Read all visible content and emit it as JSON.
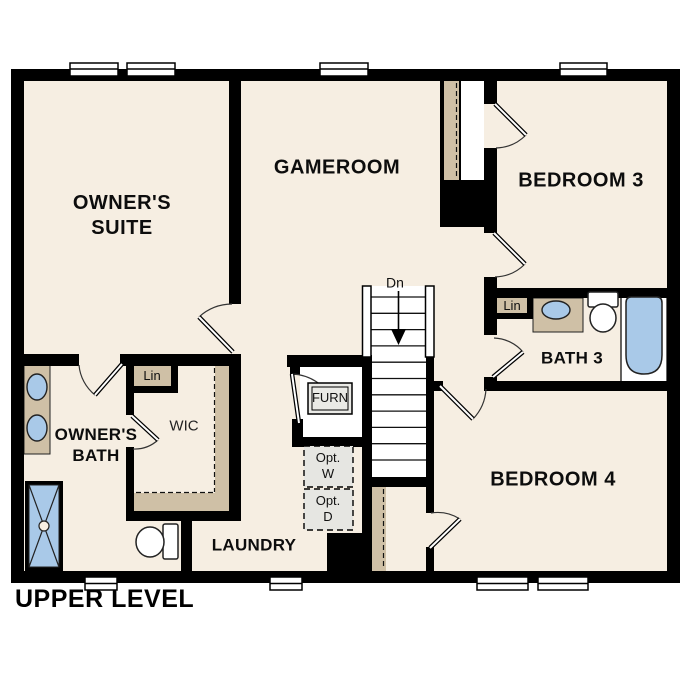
{
  "plan": {
    "title": "UPPER LEVEL",
    "labels": {
      "owners_suite_line1": "OWNER'S",
      "owners_suite_line2": "SUITE",
      "gameroom": "GAMEROOM",
      "bedroom3": "BEDROOM 3",
      "bedroom4": "BEDROOM 4",
      "bath3": "BATH 3",
      "owners_bath_line1": "OWNER'S",
      "owners_bath_line2": "BATH",
      "wic": "WIC",
      "laundry": "LAUNDRY",
      "lin_wic": "Lin",
      "lin_bath3": "Lin",
      "furn": "FURN",
      "opt_w_line1": "Opt.",
      "opt_w_line2": "W",
      "opt_d_line1": "Opt.",
      "opt_d_line2": "D",
      "stairs_down": "Dn"
    },
    "colors": {
      "background": "#FFFFFF",
      "wall": "#000000",
      "floor": "#F6EEE2",
      "casework_tan": "#CFC0A6",
      "fixture_blue": "#A9C9E8",
      "optional_gray": "#E6E6E2",
      "closet_white": "#FFFFFF"
    }
  }
}
